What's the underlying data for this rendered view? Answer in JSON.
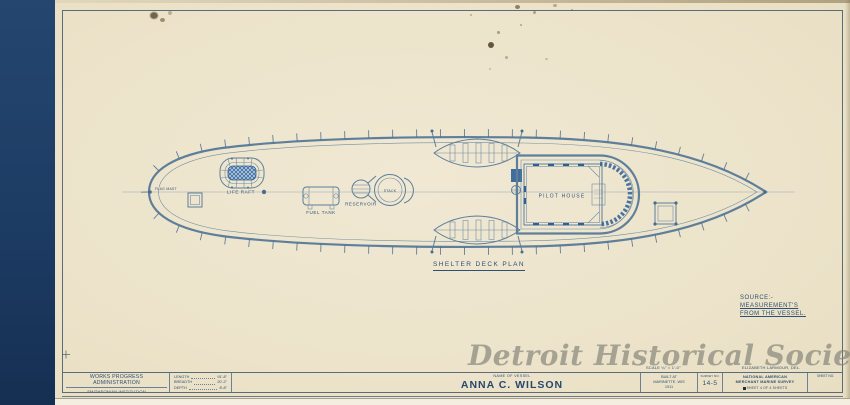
{
  "colors": {
    "paper": "#ece3ca",
    "navy": "#1e3d66",
    "ink": "#2f4f74",
    "line": "#5d7f9b",
    "blue": "#2e5f96",
    "watermark": "#7c7b72"
  },
  "watermark_text": "Detroit Historical Society",
  "drawing": {
    "plan_title": "SHELTER DECK PLAN",
    "labels": {
      "flag_mast": "FLAG MAST",
      "life_raft": "LIFE RAFT",
      "fuel_tank": "FUEL TANK",
      "reservoir": "RESERVOIR",
      "stack": "STACK",
      "pilot_house": "PILOT HOUSE"
    },
    "source_note": [
      "SOURCE:-",
      "MEASUREMENT'S",
      "FROM THE VESSEL."
    ]
  },
  "title_block": {
    "agency": [
      "WORKS PROGRESS ADMINISTRATION",
      "SMITHSONIAN INSTITUTION",
      "U. S. NATIONAL MUSEUM"
    ],
    "dims": [
      {
        "label": "LENGTH",
        "value": "91'-8\""
      },
      {
        "label": "BREADTH",
        "value": "20'-2\""
      },
      {
        "label": "DEPTH",
        "value": "8'-8\""
      }
    ],
    "vessel_label": "NAME OF VESSEL",
    "vessel_name": "ANNA C. WILSON",
    "scale_note": "SCALE ¼\" = 1'-0\"",
    "delineator": "ELIZABETH LARMOUR, DEL.",
    "built": [
      "BUILT AT",
      "MARINETTE,  WIS",
      "1911"
    ],
    "survey_label": "SURVEY NO.",
    "survey_no": "14-5",
    "org": [
      "NATIONAL AMERICAN",
      "MERCHANT MARINE SURVEY"
    ],
    "sheet_line": "SHEET 4 OF 4 SHEETS",
    "sheet_no_label": "SHEET NO."
  }
}
